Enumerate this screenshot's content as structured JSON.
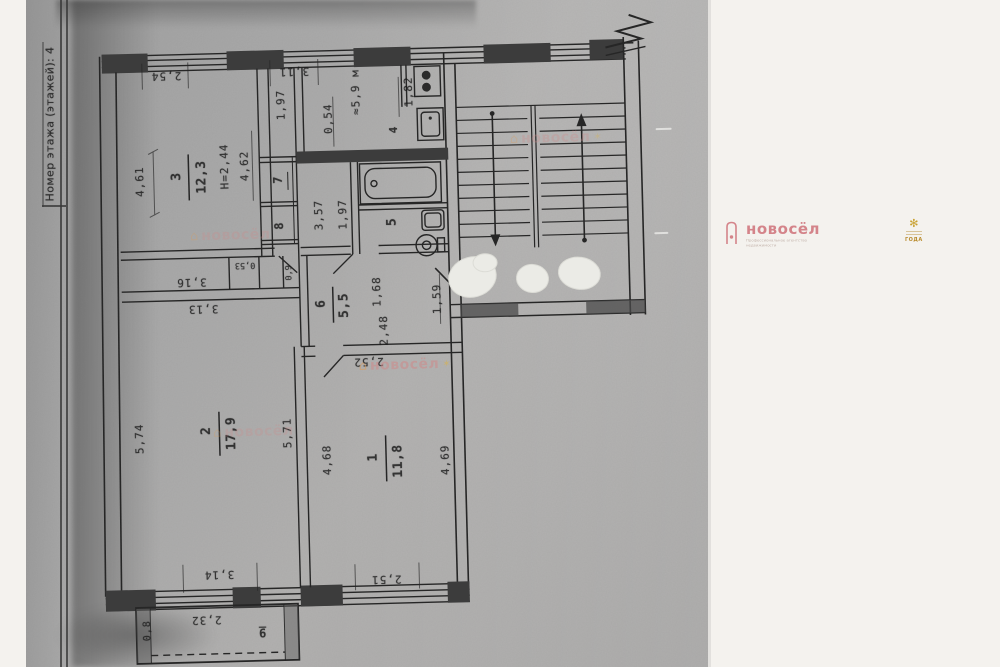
{
  "document": {
    "side_label": "Номер этажа (этажей): 4"
  },
  "plan": {
    "rooms": [
      {
        "number": "3",
        "area": "12,3"
      },
      {
        "number": "2",
        "area": "17,9"
      },
      {
        "number": "1",
        "area": "11,8"
      },
      {
        "number": "6",
        "area": "5,5"
      },
      {
        "number": "4"
      },
      {
        "number": "5"
      },
      {
        "number": "7"
      },
      {
        "number": "8"
      },
      {
        "number": "9"
      }
    ],
    "notes": {
      "height_note": "Н=2,44",
      "kitchen_area": "≈5,9 м"
    },
    "dims": {
      "d4_61": "4,61",
      "d2_54": "2,54",
      "d3_11": "3,11",
      "d1_97_top": "1,97",
      "d0_54": "0,54",
      "d1_82": "1,82",
      "d4_62": "4,62",
      "d3_57": "3,57",
      "d1_97_mid": "1,97",
      "d1_68": "1,68",
      "d2_48": "2,48",
      "d1_59": "1,59",
      "d0_53": "0,53",
      "d0_9": "0,9",
      "d3_16": "3,16",
      "d3_13": "3,13",
      "d2_52": "2,52",
      "d5_74": "5,74",
      "d5_71": "5,71",
      "d4_68": "4,68",
      "d4_69": "4,69",
      "d2_51": "2,51",
      "d3_14": "3,14",
      "d2_32": "2,32",
      "d0_8": "0,8"
    }
  },
  "watermark": {
    "brand": "новосёл",
    "tagline": "Профессиональное агентство недвижимости",
    "badge_text": "ГОДА",
    "brand_color": "#d4848a",
    "gold_color": "#c8a02e"
  },
  "colors": {
    "paper": "#a9a9a9",
    "ink": "#262626",
    "background": "#f4f2ee"
  }
}
